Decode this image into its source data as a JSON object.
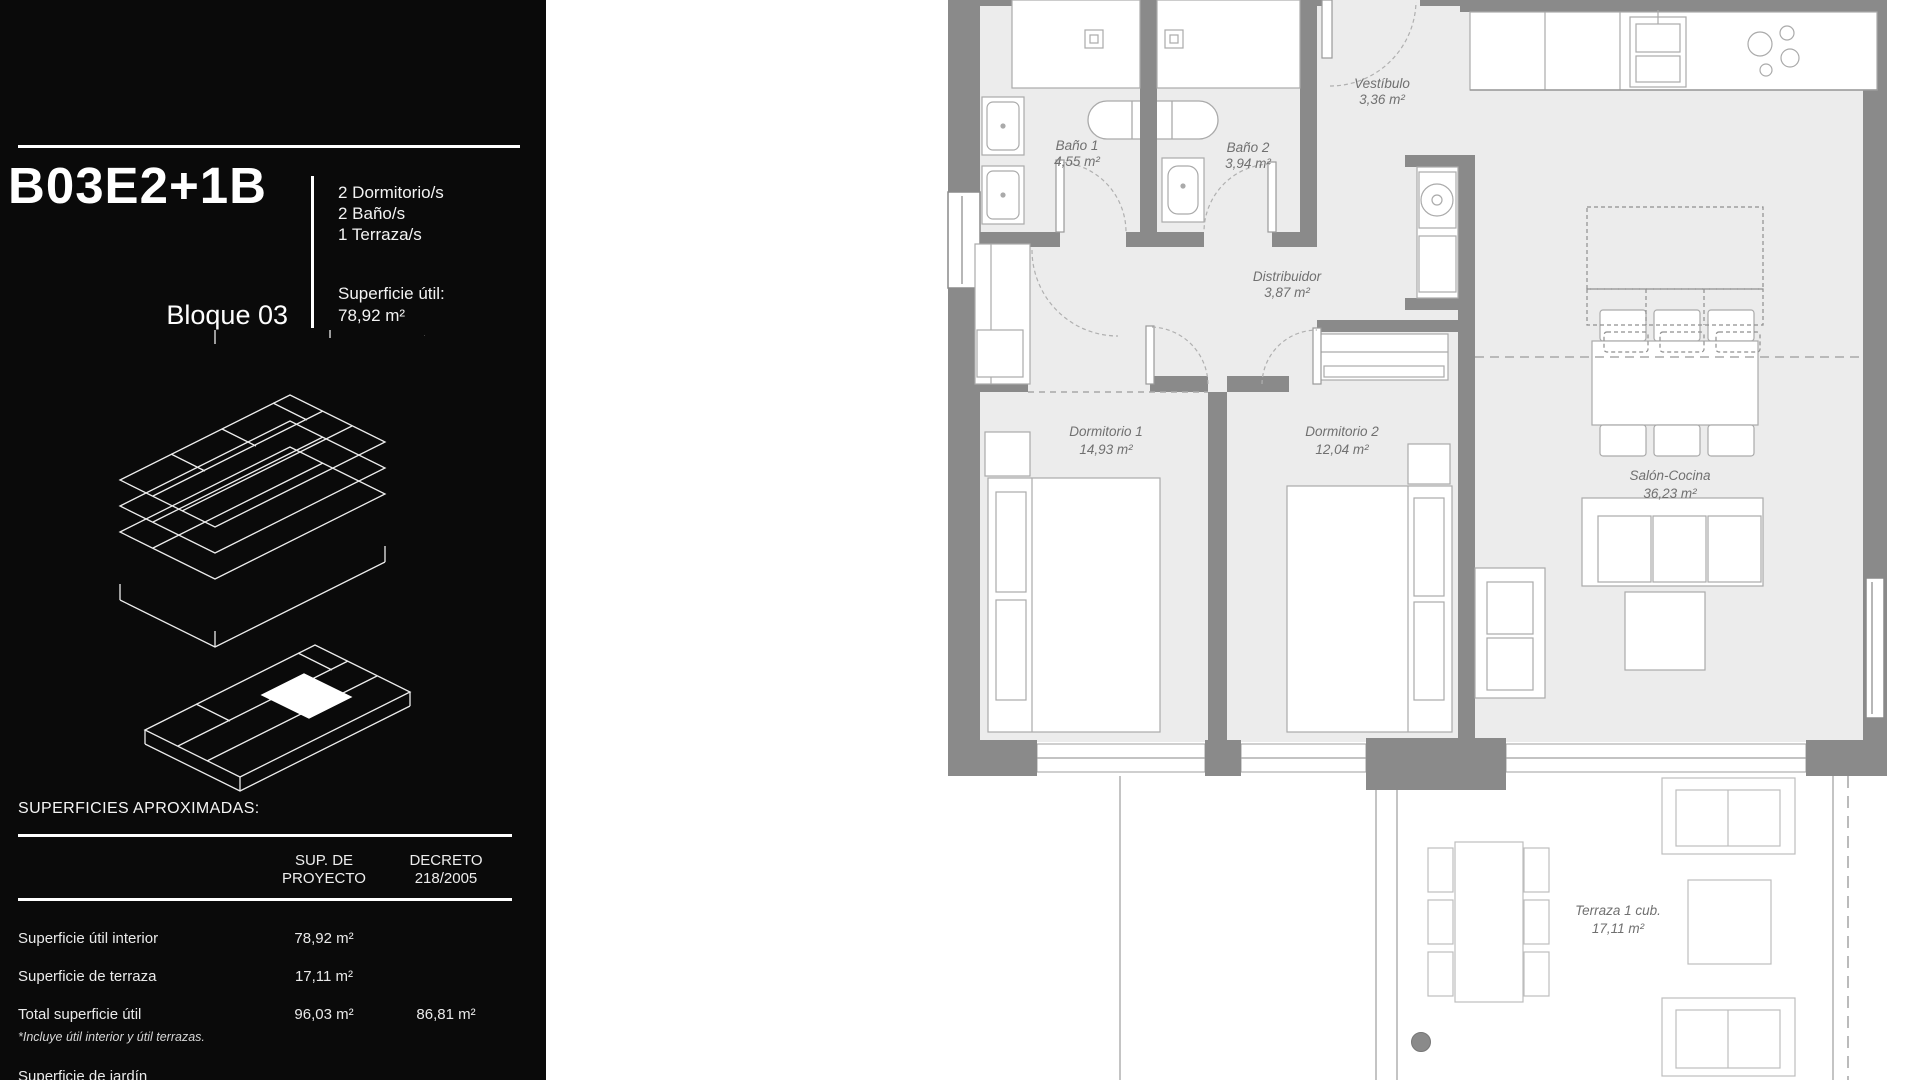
{
  "sidebar": {
    "unit_code": "B03E2+1B",
    "block_label": "Bloque 03",
    "features": [
      "2 Dormitorio/s",
      "2 Baño/s",
      "1 Terraza/s"
    ],
    "surface_label": "Superficie útil:",
    "surface_value": "78,92 m²",
    "areas_table": {
      "title": "SUPERFICIES APROXIMADAS:",
      "col_project_line1": "SUP. DE",
      "col_project_line2": "PROYECTO",
      "col_decree_line1": "DECRETO",
      "col_decree_line2": "218/2005",
      "rows": [
        {
          "label": "Superficie útil interior",
          "proyecto": "78,92 m²",
          "decreto": ""
        },
        {
          "label": "Superficie de terraza",
          "proyecto": "17,11 m²",
          "decreto": ""
        },
        {
          "label": "Total superficie útil",
          "proyecto": "96,03 m²",
          "decreto": "86,81 m²"
        },
        {
          "label": "Superficie de jardín",
          "proyecto": "",
          "decreto": ""
        }
      ],
      "note": "*Incluye útil interior y útil terrazas."
    }
  },
  "plan": {
    "watermark": "m",
    "rooms": [
      {
        "name": "Baño 1",
        "area": "4,55 m²"
      },
      {
        "name": "Baño 2",
        "area": "3,94 m²"
      },
      {
        "name": "Vestíbulo",
        "area": "3,36 m²"
      },
      {
        "name": "Distribuidor",
        "area": "3,87 m²"
      },
      {
        "name": "Dormitorio 1",
        "area": "14,93 m²"
      },
      {
        "name": "Dormitorio 2",
        "area": "12,04 m²"
      },
      {
        "name": "Salón-Cocina",
        "area": "36,23 m²"
      },
      {
        "name": "Terraza 1 cub.",
        "area": "17,11 m²"
      }
    ]
  },
  "colors": {
    "sidebar_bg": "#0a0a0a",
    "wall": "#8a8a8a",
    "floor": "#ececec",
    "label": "#707070"
  }
}
